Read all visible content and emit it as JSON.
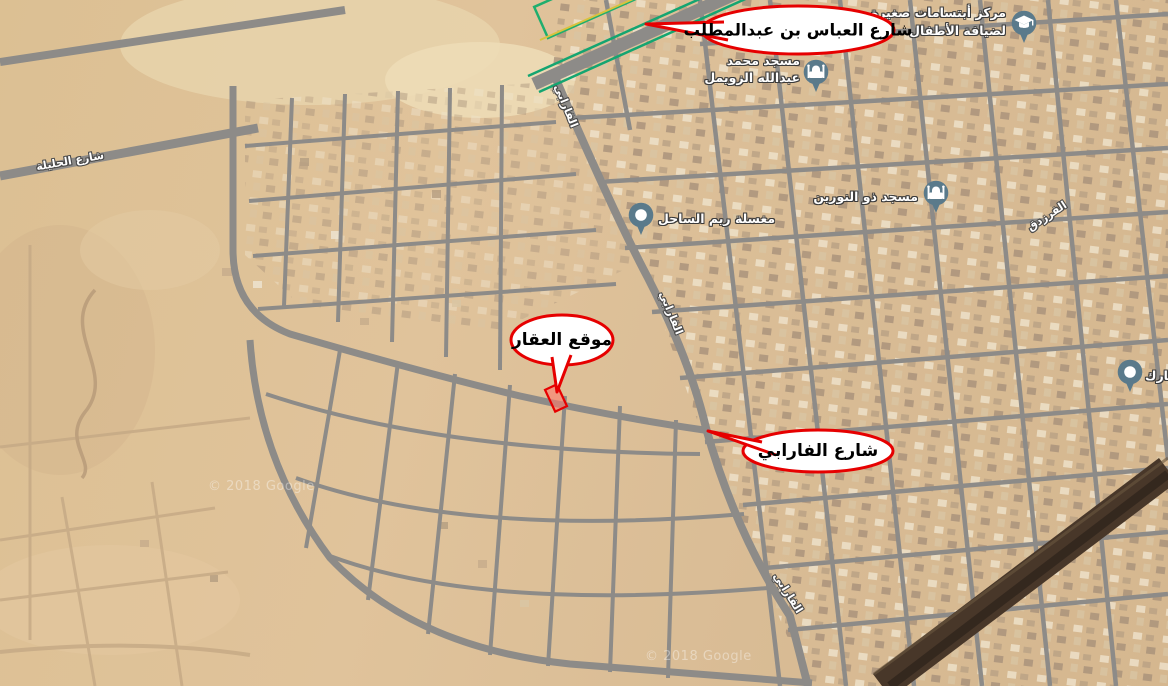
{
  "map": {
    "callouts": [
      {
        "id": "abbas-street",
        "label": "شارع العباس بن عبدالمطلب"
      },
      {
        "id": "property-location",
        "label": "موقع العقار"
      },
      {
        "id": "farabi-street",
        "label": "شارع الفارابي"
      }
    ],
    "pois": [
      {
        "id": "mosque-zuwaimel",
        "icon": "mosque-icon",
        "lines": [
          "مسجد محمد",
          "عبدالله الزويمل"
        ]
      },
      {
        "id": "smiles-center",
        "icon": "education-icon",
        "lines": [
          "مركز أبتسامات صغيرة",
          "لضيافة الأطفال"
        ]
      },
      {
        "id": "mosque-nurayn",
        "icon": "mosque-icon",
        "lines": [
          "مسجد ذو النورين"
        ]
      },
      {
        "id": "laundry-reem",
        "icon": "place-icon",
        "lines": [
          "مغسلة ريم الساحل"
        ]
      },
      {
        "id": "bumohammed",
        "icon": "place-icon",
        "lines": [
          "بومحمد المبارك"
        ]
      }
    ],
    "street_labels": [
      {
        "id": "haleela",
        "text": "شارع الحليلة"
      },
      {
        "id": "farabi-top",
        "text": "الفارابي"
      },
      {
        "id": "farabi-mid",
        "text": "الفارابي"
      },
      {
        "id": "farabi-bottom",
        "text": "الفارابي"
      },
      {
        "id": "farazdaq",
        "text": "الفرزدق"
      }
    ],
    "watermark": {
      "text": "© 2018 Google"
    },
    "colors": {
      "sand": "#dcc093",
      "road_gray": "#8d8b88",
      "highway_green": "#14a571",
      "callout_red": "#e60000",
      "parcel_fill": "#ff7a6a",
      "pin_blue": "#5a7a8b",
      "dark_strip": "#483729"
    }
  }
}
